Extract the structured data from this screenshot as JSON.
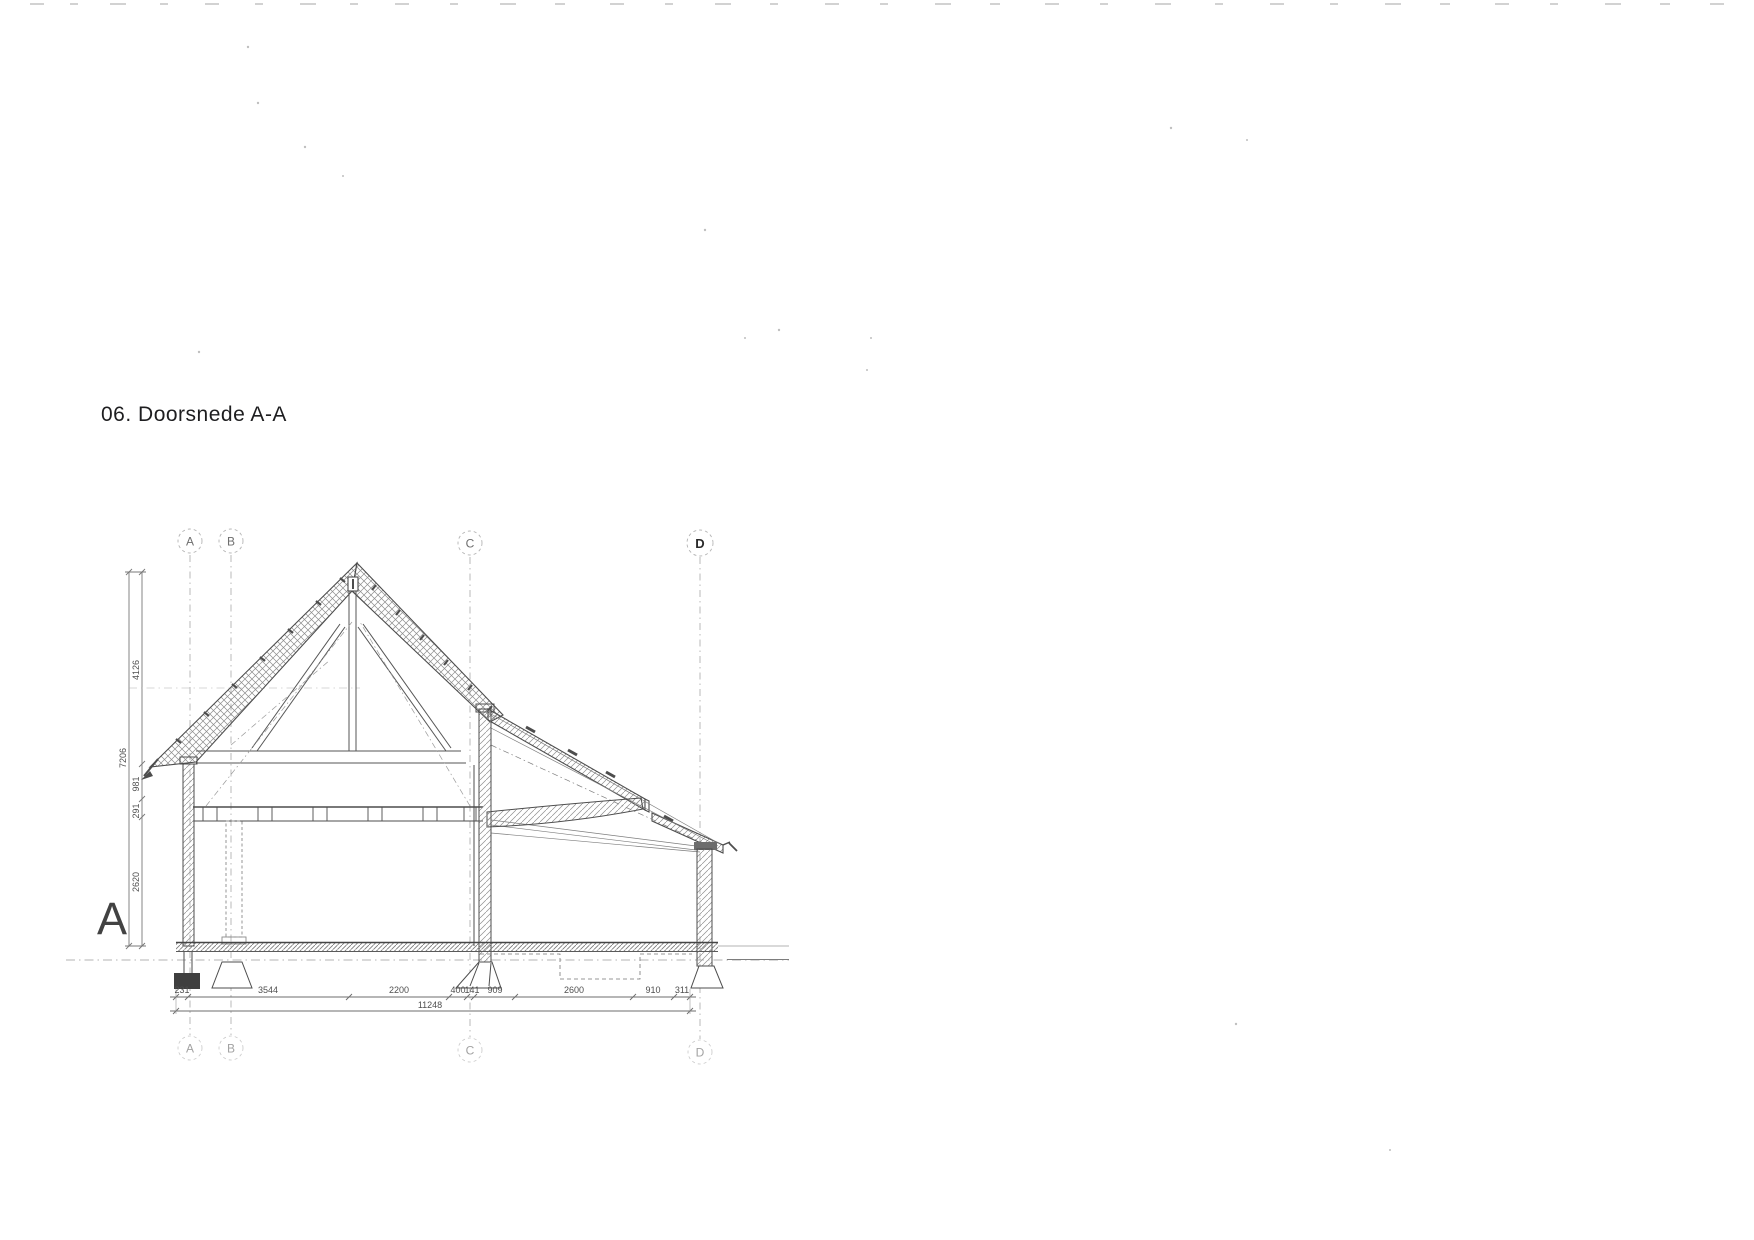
{
  "page": {
    "title": "06. Doorsnede A-A",
    "section_marker": "A"
  },
  "grid_bubbles": {
    "top": [
      "A",
      "B",
      "C",
      "D"
    ],
    "bottom": [
      "A",
      "B",
      "C",
      "D"
    ]
  },
  "dimensions": {
    "vertical_total": "7206",
    "vertical_segments": [
      "4126",
      "981",
      "291",
      "2620"
    ],
    "horizontal_segments": [
      "231",
      "3544",
      "2200",
      "400",
      "141",
      "909",
      "2600",
      "910",
      "311"
    ],
    "horizontal_total": "11248"
  },
  "colors": {
    "paper": "#ffffff",
    "ink": "#4a4a4a",
    "thin_ink": "#757575",
    "hatch": "#8a8a8a",
    "grid_line": "#a5a5a5",
    "title_ink": "#1e1e20",
    "footing_fill": "#3f3f3f"
  }
}
